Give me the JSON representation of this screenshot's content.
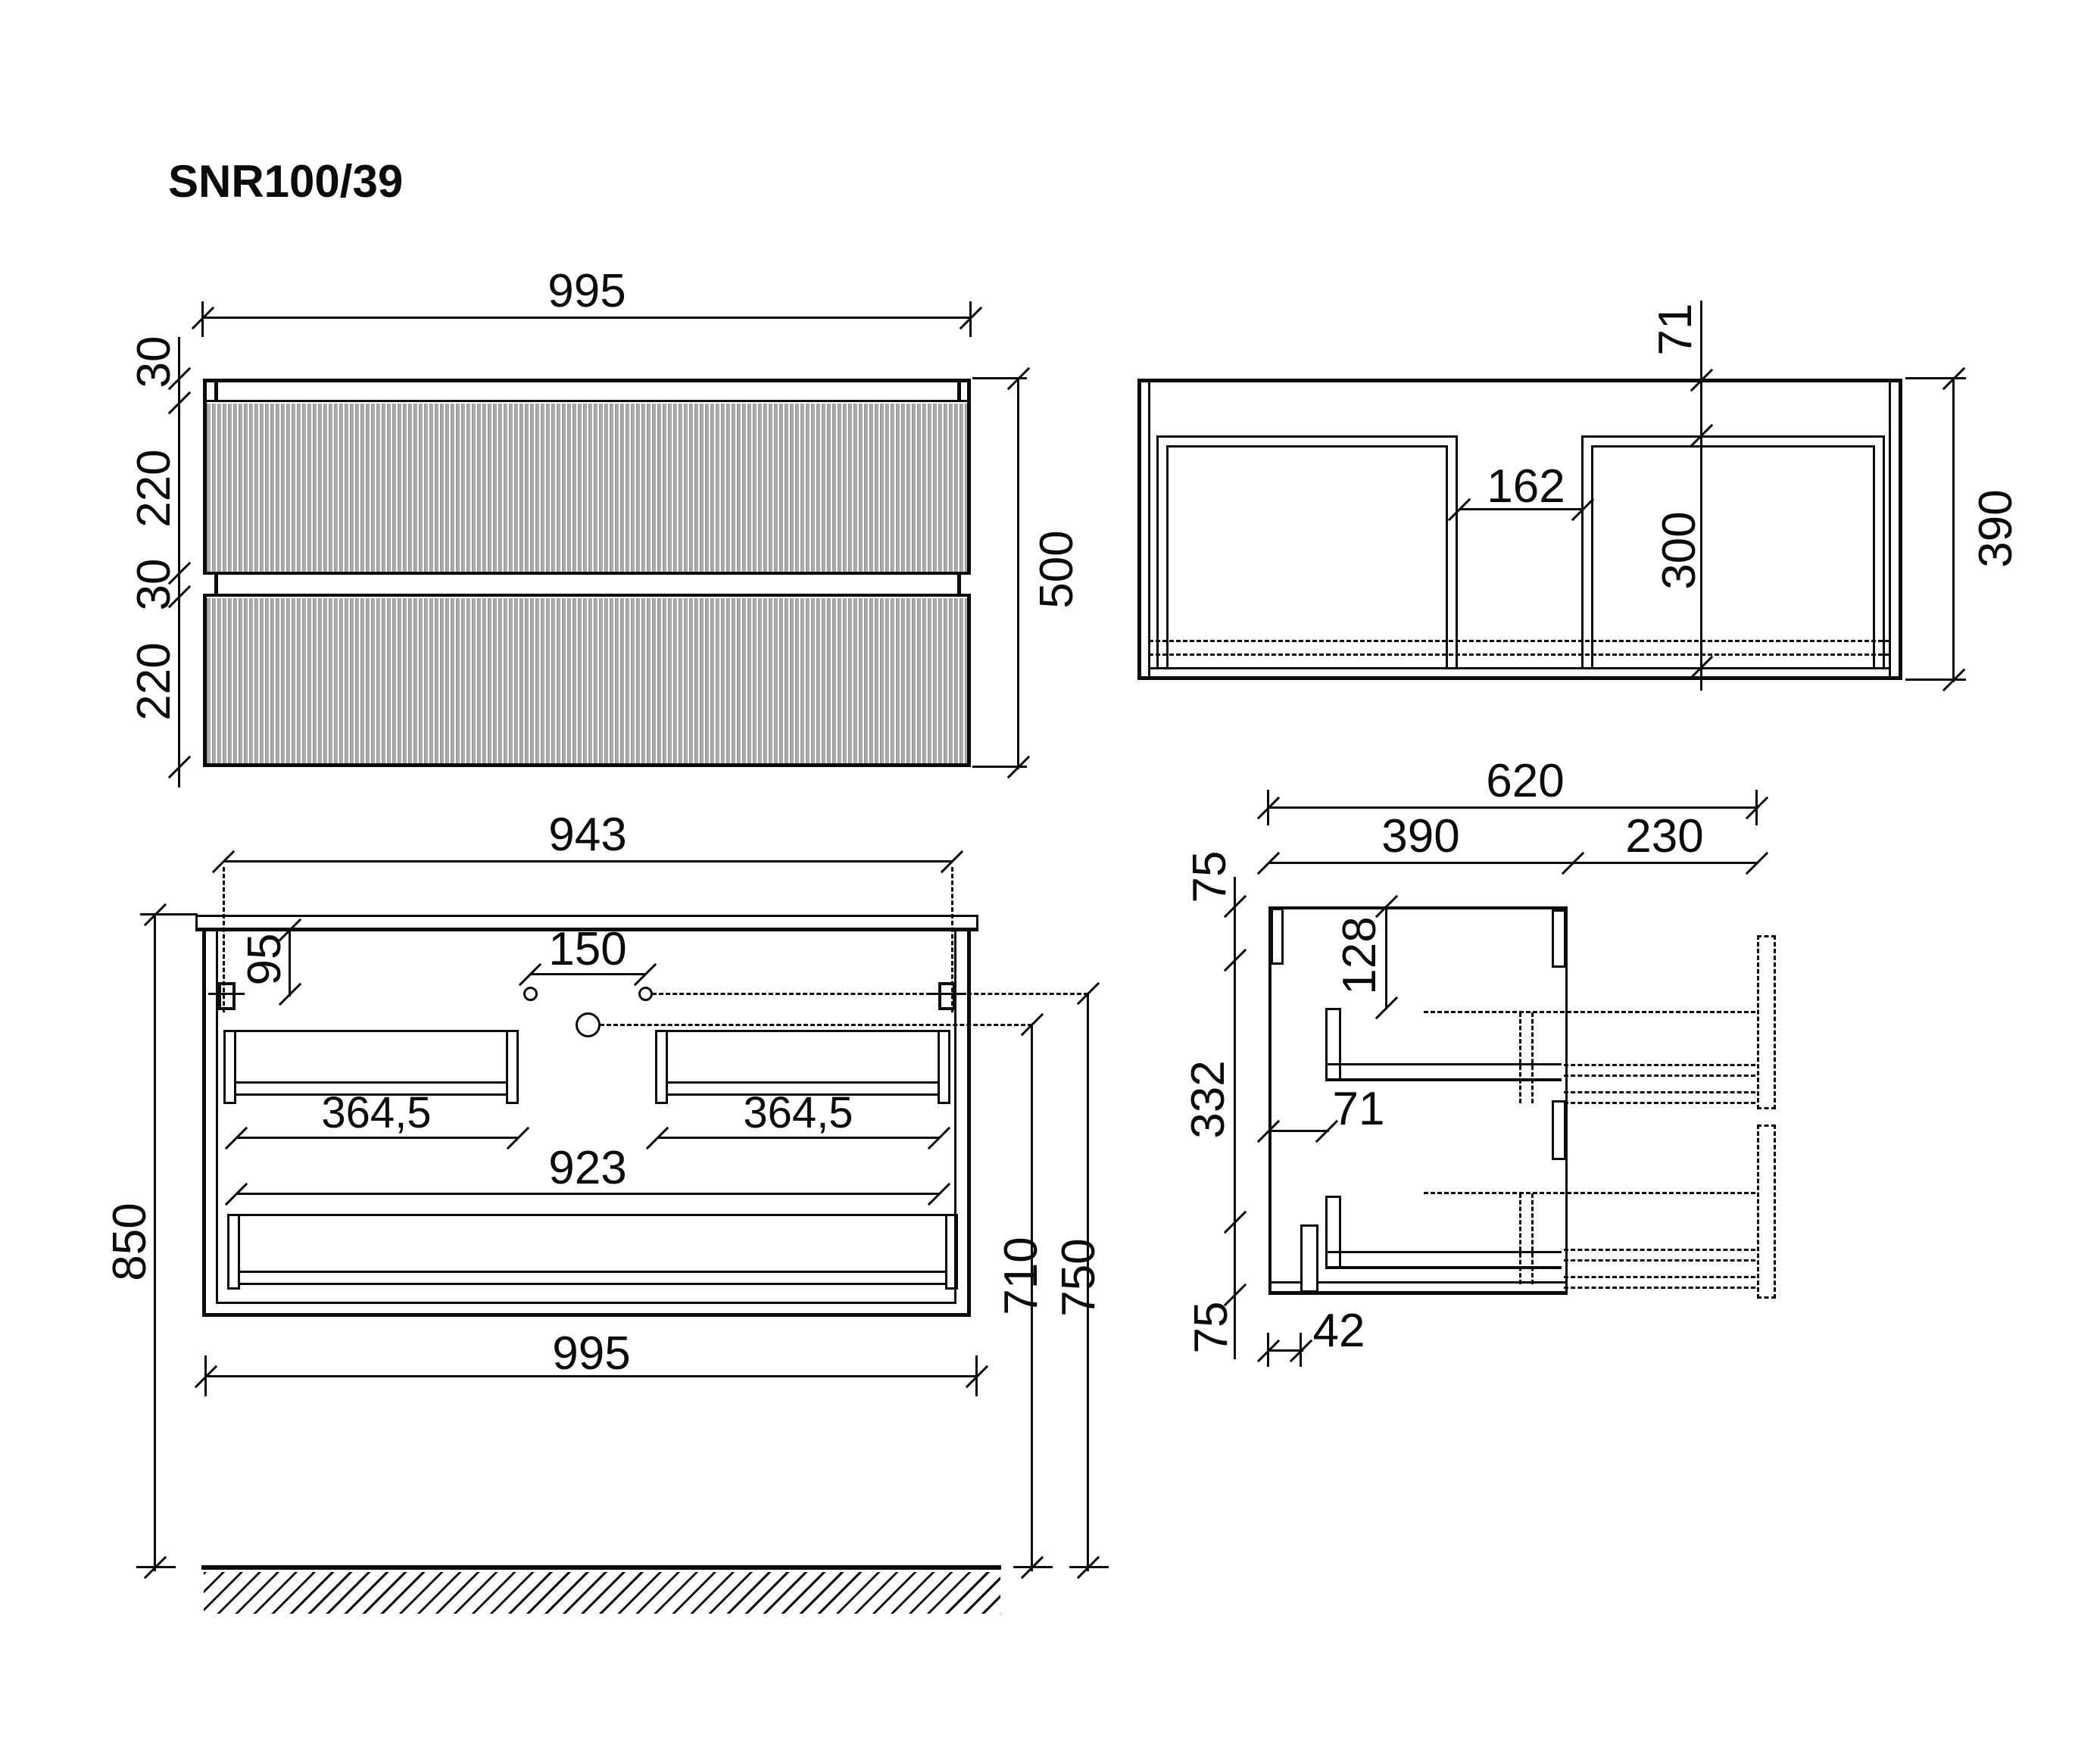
{
  "title": "SNR100/39",
  "front_view": {
    "width": "995",
    "height": "500",
    "segments": [
      "30",
      "220",
      "30",
      "220"
    ]
  },
  "plan_view": {
    "back_offset": "71",
    "center_gap": "162",
    "drawer_depth": "300",
    "depth": "390"
  },
  "mount_view": {
    "hanger_span": "943",
    "hanger_drop": "95",
    "hole_spacing": "150",
    "left_rail": "364,5",
    "right_rail": "364,5",
    "bottom_rail": "923",
    "width": "995",
    "top_height": "850",
    "drain_height": "710",
    "holes_height": "750"
  },
  "side_view": {
    "total_depth": "620",
    "body_depth": "390",
    "front_extension": "230",
    "top_gap": "75",
    "mid_span": "332",
    "bottom_gap": "75",
    "rail_drop": "128",
    "back_clearance": "71",
    "foot_inset": "42"
  }
}
